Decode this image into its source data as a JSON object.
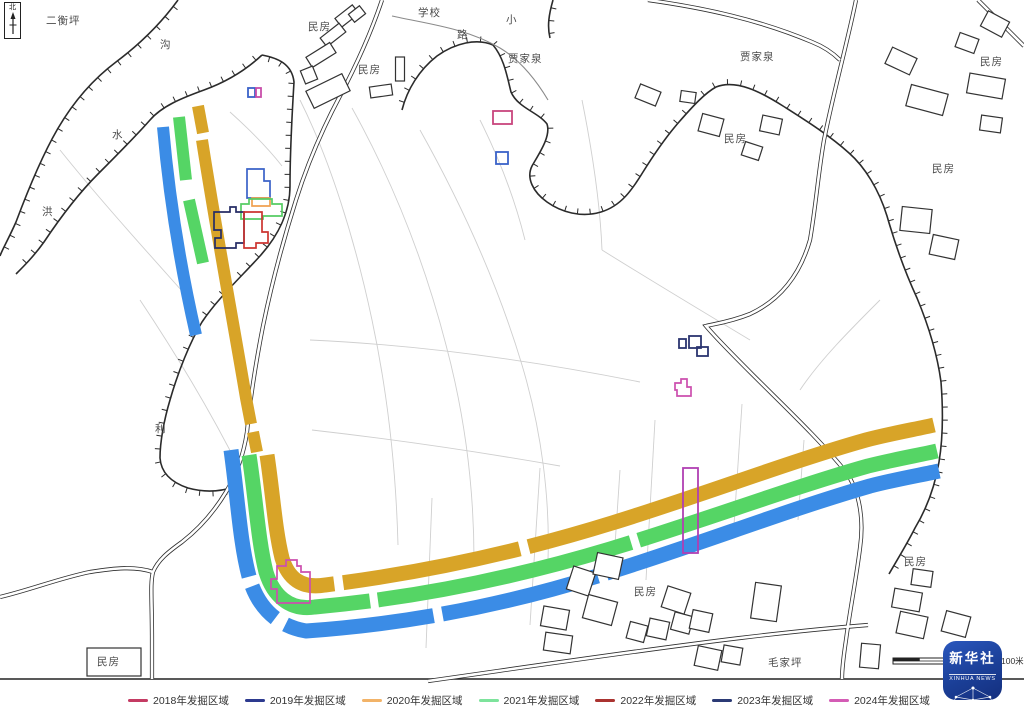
{
  "north_label": "北",
  "scale_label": "100米",
  "logo": {
    "cn": "新华社",
    "en": "XINHUA NEWS"
  },
  "legend": {
    "items": [
      {
        "label": "2018年发掘区域",
        "color": "#c43b63"
      },
      {
        "label": "2019年发掘区域",
        "color": "#2d3a8f"
      },
      {
        "label": "2020年发掘区域",
        "color": "#f2b368"
      },
      {
        "label": "2021年发掘区域",
        "color": "#7de39c"
      },
      {
        "label": "2022年发掘区域",
        "color": "#aa3330"
      },
      {
        "label": "2023年发掘区域",
        "color": "#2b3a75"
      },
      {
        "label": "2024年发掘区域",
        "color": "#d45cb5"
      }
    ]
  },
  "map_labels": [
    {
      "t": "二衡坪",
      "x": 46,
      "y": 24
    },
    {
      "t": "沟",
      "x": 160,
      "y": 48
    },
    {
      "t": "水",
      "x": 112,
      "y": 138
    },
    {
      "t": "洪",
      "x": 42,
      "y": 215
    },
    {
      "t": "民房",
      "x": 308,
      "y": 30
    },
    {
      "t": "学校",
      "x": 418,
      "y": 16
    },
    {
      "t": "小",
      "x": 506,
      "y": 23
    },
    {
      "t": "路",
      "x": 457,
      "y": 38
    },
    {
      "t": "民房",
      "x": 358,
      "y": 73
    },
    {
      "t": "贾家泉",
      "x": 508,
      "y": 62
    },
    {
      "t": "贾家泉",
      "x": 740,
      "y": 60
    },
    {
      "t": "民房",
      "x": 724,
      "y": 142
    },
    {
      "t": "民房",
      "x": 980,
      "y": 65
    },
    {
      "t": "民房",
      "x": 932,
      "y": 172
    },
    {
      "t": "利",
      "x": 155,
      "y": 432
    },
    {
      "t": "民房",
      "x": 634,
      "y": 595
    },
    {
      "t": "民房",
      "x": 904,
      "y": 565
    },
    {
      "t": "毛家坪",
      "x": 768,
      "y": 666
    },
    {
      "t": "民房",
      "x": 97,
      "y": 665
    }
  ],
  "geometry": {
    "frame_y": 679,
    "field_lines": [
      "M300,100 C330,160 355,240 372,320 C388,395 396,470 398,545",
      "M352,108 C392,180 424,260 446,345 C466,420 474,490 474,560",
      "M420,130 C462,205 498,285 522,365 C542,432 550,500 548,560",
      "M310,340 C420,345 530,360 640,382",
      "M312,430 C400,440 480,452 560,466",
      "M655,420 L646,580",
      "M742,404 L734,525",
      "M540,468 L530,625",
      "M432,498 L426,648",
      "M582,100 C592,150 600,200 602,250",
      "M602,250 C650,280 700,310 750,340",
      "M140,300 C180,360 215,420 240,470",
      "M60,150 C100,200 150,255 190,300",
      "M620,470 L614,560",
      "M804,440 L798,520",
      "M880,300 C850,330 820,360 800,390",
      "M480,120 C500,160 515,200 525,240",
      "M230,112 C250,130 268,148 282,166"
    ],
    "terrain": [
      {
        "d": "M178,0 C162,22 140,44 116,62 C92,80 72,104 57,130 C42,156 28,190 16,222 C8,240 2,250 0,256",
        "side": -1
      },
      {
        "d": "M262,55 C246,70 226,82 204,90 C182,98 162,106 150,120 C136,136 116,156 98,174 C78,194 60,218 44,242 C34,256 24,266 16,274",
        "side": 1
      },
      {
        "d": "M262,55 C278,58 292,64 294,82 C292,115 290,150 290,186 C290,212 278,236 260,256 C242,276 218,298 202,322 C190,342 178,372 170,400 C164,420 160,442 160,458 C161,472 170,482 188,488 C206,493 222,491 234,487",
        "side": 1
      },
      {
        "d": "M402,110 C407,90 419,70 437,56 C455,43 477,38 493,45 C504,58 507,76 511,92 C518,108 538,112 547,124 C551,136 540,152 532,166 C526,178 533,192 547,202 C561,212 581,218 601,212 C621,206 632,190 643,172 C653,156 665,138 679,122 C693,106 705,93 716,87 C736,79 761,92 783,106 C805,120 829,135 849,153 C865,167 879,190 887,216 C895,244 905,272 917,298 C927,322 937,352 941,382 C943,408 943,438 939,462 C935,486 927,508 915,528 C907,544 897,560 889,574",
        "side": -1
      },
      {
        "d": "M553,0 C549,14 547,26 550,38",
        "side": -1
      }
    ],
    "streams": [
      "M392,16 C428,24 466,28 500,48 C520,60 536,80 548,100"
    ],
    "roads": [
      "M382,0 C372,30 358,62 340,96 C324,126 308,162 296,200 C284,238 272,282 263,326 C256,362 250,400 247,432",
      "M247,432 C244,452 238,472 226,492 C214,512 200,528 182,542 C168,552 158,560 153,572 C150,584 152,600 152,640 L152,679",
      "M0,597 C30,590 60,578 90,572 C115,568 135,566 153,572",
      "M856,0 C848,40 834,90 824,140 C818,175 816,205 810,240 C800,275 780,300 750,314 C730,322 714,324 706,326 C716,338 734,356 752,374 C786,408 820,440 846,472 C860,492 864,520 860,548 C856,580 850,610 846,640 C843,660 842,670 842,679",
      "M648,0 C705,8 760,20 812,42 C822,46 832,52 840,60",
      "M978,0 L1024,46",
      "M428,681 C520,668 640,650 740,638 C790,632 830,628 868,625"
    ],
    "stripes": [
      {
        "name": "trench-yellow-a",
        "color": "#d8a428",
        "w": 12,
        "d": "M198,106 L203,133"
      },
      {
        "name": "trench-yellow-b",
        "color": "#d8a428",
        "w": 12,
        "d": "M202,140 C216,230 232,315 246,398 L251,424"
      },
      {
        "name": "trench-yellow-c",
        "color": "#d8a428",
        "w": 12,
        "d": "M253,432 L257,452"
      },
      {
        "name": "trench-yellow-main",
        "color": "#d8a428",
        "w": 15,
        "dash": "170 9 180 9 2000",
        "d": "M267,455 C273,495 275,530 282,558 C288,578 301,589 325,585 C430,572 525,550 612,523 C700,496 788,462 866,440 C893,433 917,429 934,425"
      },
      {
        "name": "trench-green-a",
        "color": "#55d565",
        "w": 12,
        "d": "M179,117 L186,180"
      },
      {
        "name": "trench-green-b",
        "color": "#55d565",
        "w": 12,
        "d": "M189,200 L203,263"
      },
      {
        "name": "trench-green-main",
        "color": "#55d565",
        "w": 15,
        "dash": "240 8 260 8 2000",
        "d": "M249,455 C256,500 258,540 266,572 C273,595 289,611 315,607 C425,597 520,576 610,549 C700,522 790,488 868,466 C896,459 920,455 937,451"
      },
      {
        "name": "trench-blue-a",
        "color": "#3b8ce6",
        "w": 12,
        "d": "M163,127 Q172,230 196,335"
      },
      {
        "name": "trench-blue-main",
        "color": "#3b8ce6",
        "w": 15,
        "dash": "128 10 40 12 150 9 160 9 2000",
        "d": "M231,450 C238,500 240,545 250,580 C258,606 276,626 306,631 C420,623 520,601 610,572 C700,544 790,509 870,486 C897,479 921,475 939,471"
      }
    ],
    "buildings": [
      [
        347,
        16,
        22,
        11,
        -38
      ],
      [
        333,
        35,
        24,
        11,
        -38
      ],
      [
        321,
        55,
        28,
        12,
        -32
      ],
      [
        309,
        75,
        13,
        14,
        -22
      ],
      [
        328,
        91,
        40,
        19,
        -26
      ],
      [
        400,
        69,
        9,
        24,
        0
      ],
      [
        381,
        91,
        22,
        11,
        -8
      ],
      [
        357,
        14,
        14,
        10,
        -38
      ],
      [
        648,
        95,
        22,
        15,
        22
      ],
      [
        688,
        97,
        15,
        11,
        8
      ],
      [
        711,
        125,
        22,
        18,
        15
      ],
      [
        771,
        125,
        20,
        16,
        12
      ],
      [
        752,
        151,
        18,
        14,
        18
      ],
      [
        901,
        61,
        27,
        18,
        25
      ],
      [
        967,
        43,
        20,
        15,
        20
      ],
      [
        995,
        24,
        24,
        17,
        28
      ],
      [
        986,
        86,
        36,
        20,
        10
      ],
      [
        927,
        100,
        38,
        22,
        15
      ],
      [
        991,
        124,
        21,
        15,
        8
      ],
      [
        916,
        220,
        30,
        24,
        6
      ],
      [
        944,
        247,
        26,
        20,
        12
      ],
      [
        581,
        581,
        23,
        24,
        18
      ],
      [
        608,
        566,
        26,
        22,
        12
      ],
      [
        600,
        610,
        30,
        24,
        15
      ],
      [
        555,
        618,
        26,
        20,
        10
      ],
      [
        558,
        643,
        27,
        18,
        8
      ],
      [
        637,
        632,
        18,
        17,
        15
      ],
      [
        658,
        629,
        20,
        18,
        12
      ],
      [
        682,
        623,
        19,
        18,
        15
      ],
      [
        676,
        600,
        24,
        22,
        18
      ],
      [
        701,
        621,
        20,
        19,
        12
      ],
      [
        766,
        602,
        26,
        36,
        8
      ],
      [
        708,
        658,
        24,
        20,
        12
      ],
      [
        732,
        655,
        19,
        17,
        10
      ],
      [
        907,
        600,
        28,
        19,
        10
      ],
      [
        912,
        625,
        28,
        22,
        12
      ],
      [
        956,
        624,
        25,
        21,
        15
      ],
      [
        870,
        656,
        19,
        24,
        5
      ],
      [
        922,
        578,
        20,
        16,
        8
      ],
      [
        114,
        662,
        54,
        28,
        0
      ]
    ],
    "outline_rects": [
      {
        "name": "area-outline-blue-small",
        "color": "#3a62c8",
        "x": 248,
        "y": 88,
        "w": 7,
        "h": 9
      },
      {
        "name": "area-outline-magenta-small",
        "color": "#c84faa",
        "x": 256,
        "y": 88,
        "w": 5,
        "h": 9
      },
      {
        "name": "area-outline-crimson",
        "color": "#c8457e",
        "x": 493,
        "y": 111,
        "w": 19,
        "h": 13
      },
      {
        "name": "area-outline-blue",
        "color": "#3a62c8",
        "x": 496,
        "y": 152,
        "w": 12,
        "h": 12
      },
      {
        "name": "area-outline-navy-1",
        "color": "#2b3570",
        "x": 679,
        "y": 339,
        "w": 7,
        "h": 9
      },
      {
        "name": "area-outline-navy-2",
        "color": "#2b3570",
        "x": 689,
        "y": 336,
        "w": 12,
        "h": 12
      },
      {
        "name": "area-outline-navy-3",
        "color": "#2b3570",
        "x": 697,
        "y": 347,
        "w": 11,
        "h": 9
      },
      {
        "name": "area-outline-purple-tall",
        "color": "#b13fb3",
        "x": 683,
        "y": 468,
        "w": 15,
        "h": 85
      }
    ],
    "outline_shapes": [
      {
        "name": "area-outline-2019",
        "color": "#3a62c8",
        "d": "M247,169 L264,169 L264,181 L270,181 L270,198 L247,198 Z"
      },
      {
        "name": "area-outline-2020",
        "color": "#f0a050",
        "d": "M252,198 L270,198 L270,206 L252,206 Z"
      },
      {
        "name": "area-outline-2021",
        "color": "#55cc63",
        "d": "M241,204 L249,204 L249,199 L272,199 L272,204 L282,204 L282,216 L263,216 L263,219 L241,219 Z"
      },
      {
        "name": "area-outline-2023",
        "color": "#252c66",
        "d": "M214,212 L230,212 L230,207 L236,207 L236,212 L244,212 L244,243 L236,243 L236,248 L215,248 L215,238 L221,238 L221,230 L214,230 Z"
      },
      {
        "name": "area-outline-2022",
        "color": "#cc3430",
        "d": "M244,212 L262,212 L262,232 L268,232 L268,243 L256,243 L256,248 L244,248 Z"
      },
      {
        "name": "area-outline-2024-corner",
        "color": "#cc4fae",
        "d": "M286,560 L297,560 L297,566 L301,566 L301,572 L310,572 L310,603 L277,603 L277,589 L271,589 L271,579 L277,579 L277,566 L286,566 Z"
      },
      {
        "name": "area-outline-2024-small",
        "color": "#cc4fae",
        "d": "M675,383 L681,383 L681,379 L687,379 L687,387 L691,387 L691,396 L677,396 L677,390 L675,390 Z"
      }
    ],
    "scale_bar": {
      "x": 893,
      "y": 658,
      "w": 107,
      "h": 6
    }
  }
}
